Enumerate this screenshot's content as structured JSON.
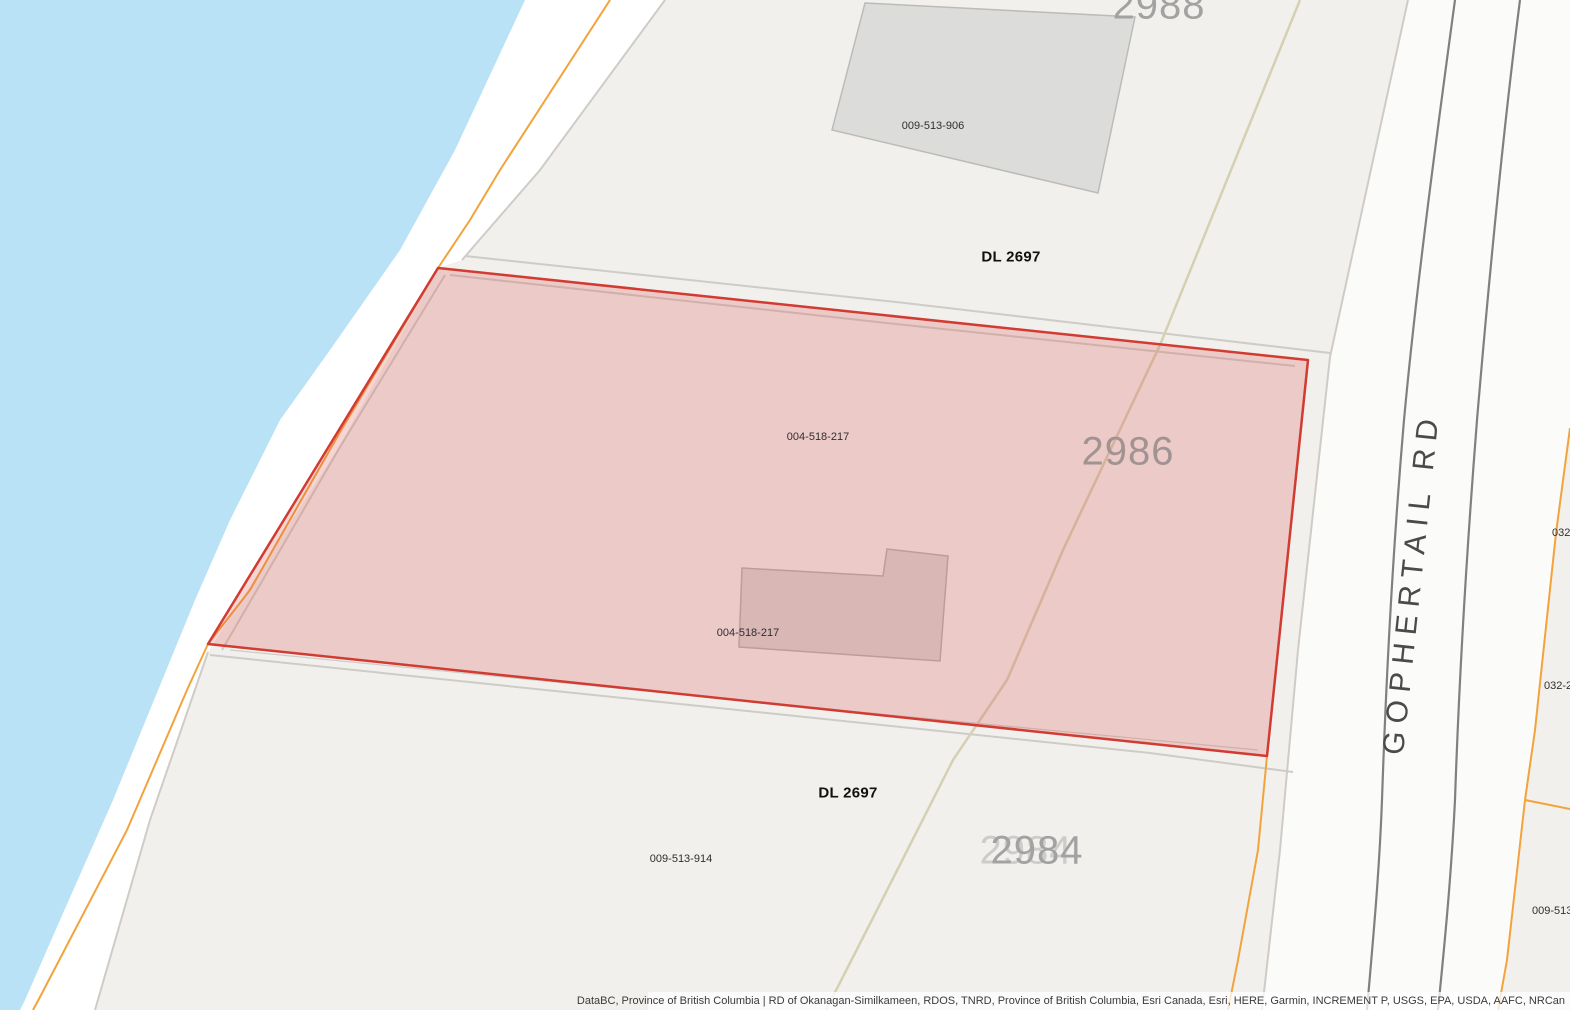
{
  "map": {
    "road": {
      "name": "GOPHERTAIL RD"
    },
    "labels": {
      "lot_2988": "2988",
      "pid_906": "009-513-906",
      "dl_2697_upper": "DL 2697",
      "pid_217_upper": "004-518-217",
      "lot_2986": "2986",
      "pid_217_lower": "004-518-217",
      "dl_2697_lower": "DL 2697",
      "lot_2984": "2984",
      "pid_914": "009-513-914",
      "edge_032_a": "032-",
      "edge_032_b": "032-2",
      "edge_009_513": "009-513-9"
    },
    "colors": {
      "water": "#b9e2f7",
      "parcel_fill": "#f1f0ed",
      "highlight_fill": "#d9534f",
      "highlight_stroke": "#d23b32",
      "cadastral_orange": "#f2a33c",
      "boundary_grey": "#cfccc7",
      "road_casing": "#808080",
      "building_fill": "#dcdcda",
      "driveway_tan": "#d6d0b3"
    },
    "attribution": "DataBC, Province of British Columbia | RD of Okanagan-Similkameen, RDOS, TNRD, Province of British Columbia, Esri Canada, Esri, HERE, Garmin, INCREMENT P, USGS, EPA, USDA, AAFC, NRCan"
  }
}
